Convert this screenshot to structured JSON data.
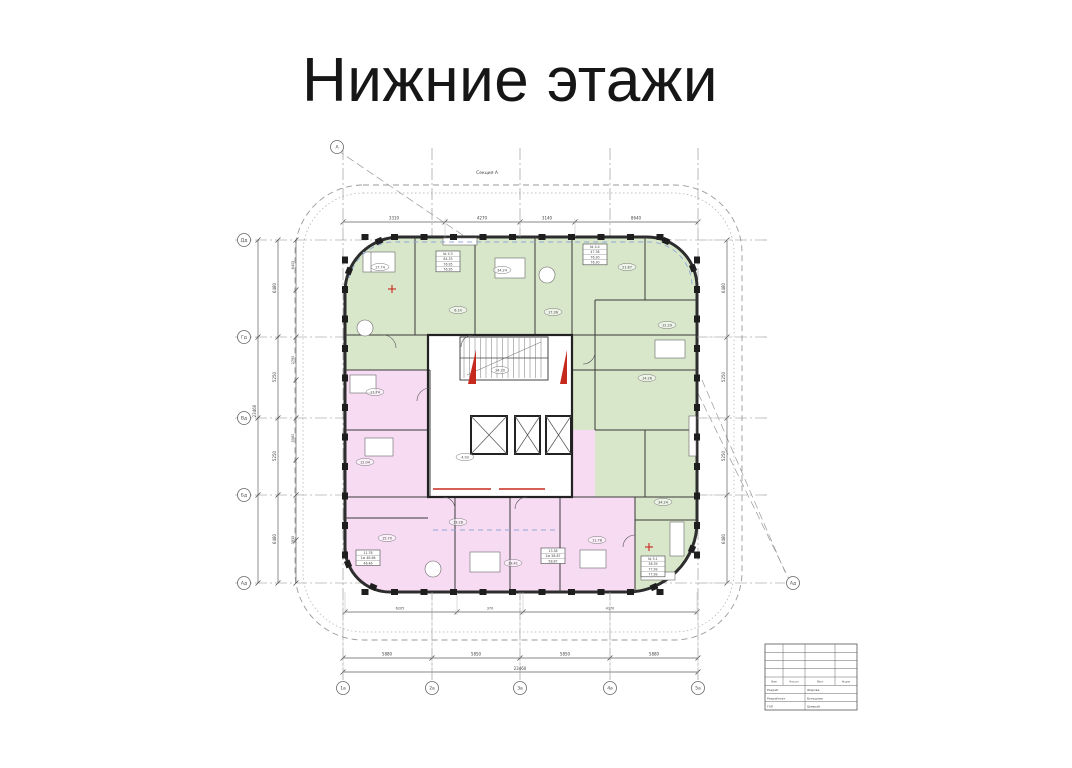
{
  "page": {
    "title": "Нижние этажи"
  },
  "plan": {
    "section_label": "Секция А",
    "colors": {
      "green": "#d8e6ca",
      "pink": "#f7dbf2",
      "wall": "#2d2d2d",
      "line": "#555555",
      "red": "#c62a1d",
      "blue": "#8fa8d8"
    },
    "axes_left": [
      "Дд",
      "Гд",
      "Вд",
      "Бд",
      "Ад"
    ],
    "axes_bottom": [
      "1а",
      "2а",
      "3а",
      "4а",
      "5а"
    ],
    "marker_top_left": "А",
    "marker_right": "Ад",
    "dims": {
      "top": [
        "3310",
        "4270",
        "3140",
        "8640"
      ],
      "left": [
        "6480",
        "5250",
        "5250",
        "6480"
      ],
      "left_total": "23460",
      "left_inner": [
        "6405",
        "2790",
        "5580",
        "3935"
      ],
      "bottom": [
        "5880",
        "5850",
        "5850",
        "5880"
      ],
      "bottom_total": "23460",
      "bottom_inner": [
        "6205",
        "370",
        "4170"
      ],
      "right": [
        "6480",
        "5250",
        "5250",
        "6480"
      ]
    },
    "room_labels": [
      {
        "x": 165,
        "y": 147,
        "v": "17.74"
      },
      {
        "x": 243,
        "y": 190,
        "v": "6.14"
      },
      {
        "x": 287,
        "y": 150,
        "v": "34.24"
      },
      {
        "x": 338,
        "y": 192,
        "v": "17.36"
      },
      {
        "x": 412,
        "y": 147,
        "v": "21.87"
      },
      {
        "x": 452,
        "y": 205,
        "v": "12.29"
      },
      {
        "x": 160,
        "y": 272,
        "v": "17.74"
      },
      {
        "x": 150,
        "y": 342,
        "v": "12.04"
      },
      {
        "x": 172,
        "y": 418,
        "v": "15.70"
      },
      {
        "x": 243,
        "y": 402,
        "v": "13.28"
      },
      {
        "x": 298,
        "y": 443,
        "v": "19.41"
      },
      {
        "x": 382,
        "y": 420,
        "v": "11.78"
      },
      {
        "x": 448,
        "y": 382,
        "v": "34.24"
      },
      {
        "x": 432,
        "y": 258,
        "v": "14.26"
      },
      {
        "x": 285,
        "y": 250,
        "v": "24.20"
      },
      {
        "x": 250,
        "y": 337,
        "v": "4.93"
      }
    ],
    "stat_boxes": [
      {
        "x": 221,
        "y": 131,
        "lines": [
          "№ 4.3",
          "84.33",
          "76.95",
          "76.95"
        ]
      },
      {
        "x": 368,
        "y": 124,
        "lines": [
          "№ 4.4",
          "47.36",
          "76.30",
          "76.30"
        ]
      },
      {
        "x": 141,
        "y": 430,
        "lines": [
          "11.78",
          "1ж 46.66",
          "46.46"
        ]
      },
      {
        "x": 326,
        "y": 428,
        "lines": [
          "13.38",
          "2ж 58.87",
          "58.87"
        ]
      },
      {
        "x": 426,
        "y": 436,
        "lines": [
          "№ 5.1",
          "38.39",
          "77.99",
          "77.99"
        ]
      }
    ]
  },
  "title_block": {
    "header": [
      "Изм",
      "Кол.уч",
      "Лист",
      "№ док"
    ],
    "rows": [
      [
        "Разраб.",
        "Жарова"
      ],
      [
        "Разработал",
        "Большова"
      ],
      [
        "ГАП",
        "Шамрай"
      ]
    ]
  }
}
